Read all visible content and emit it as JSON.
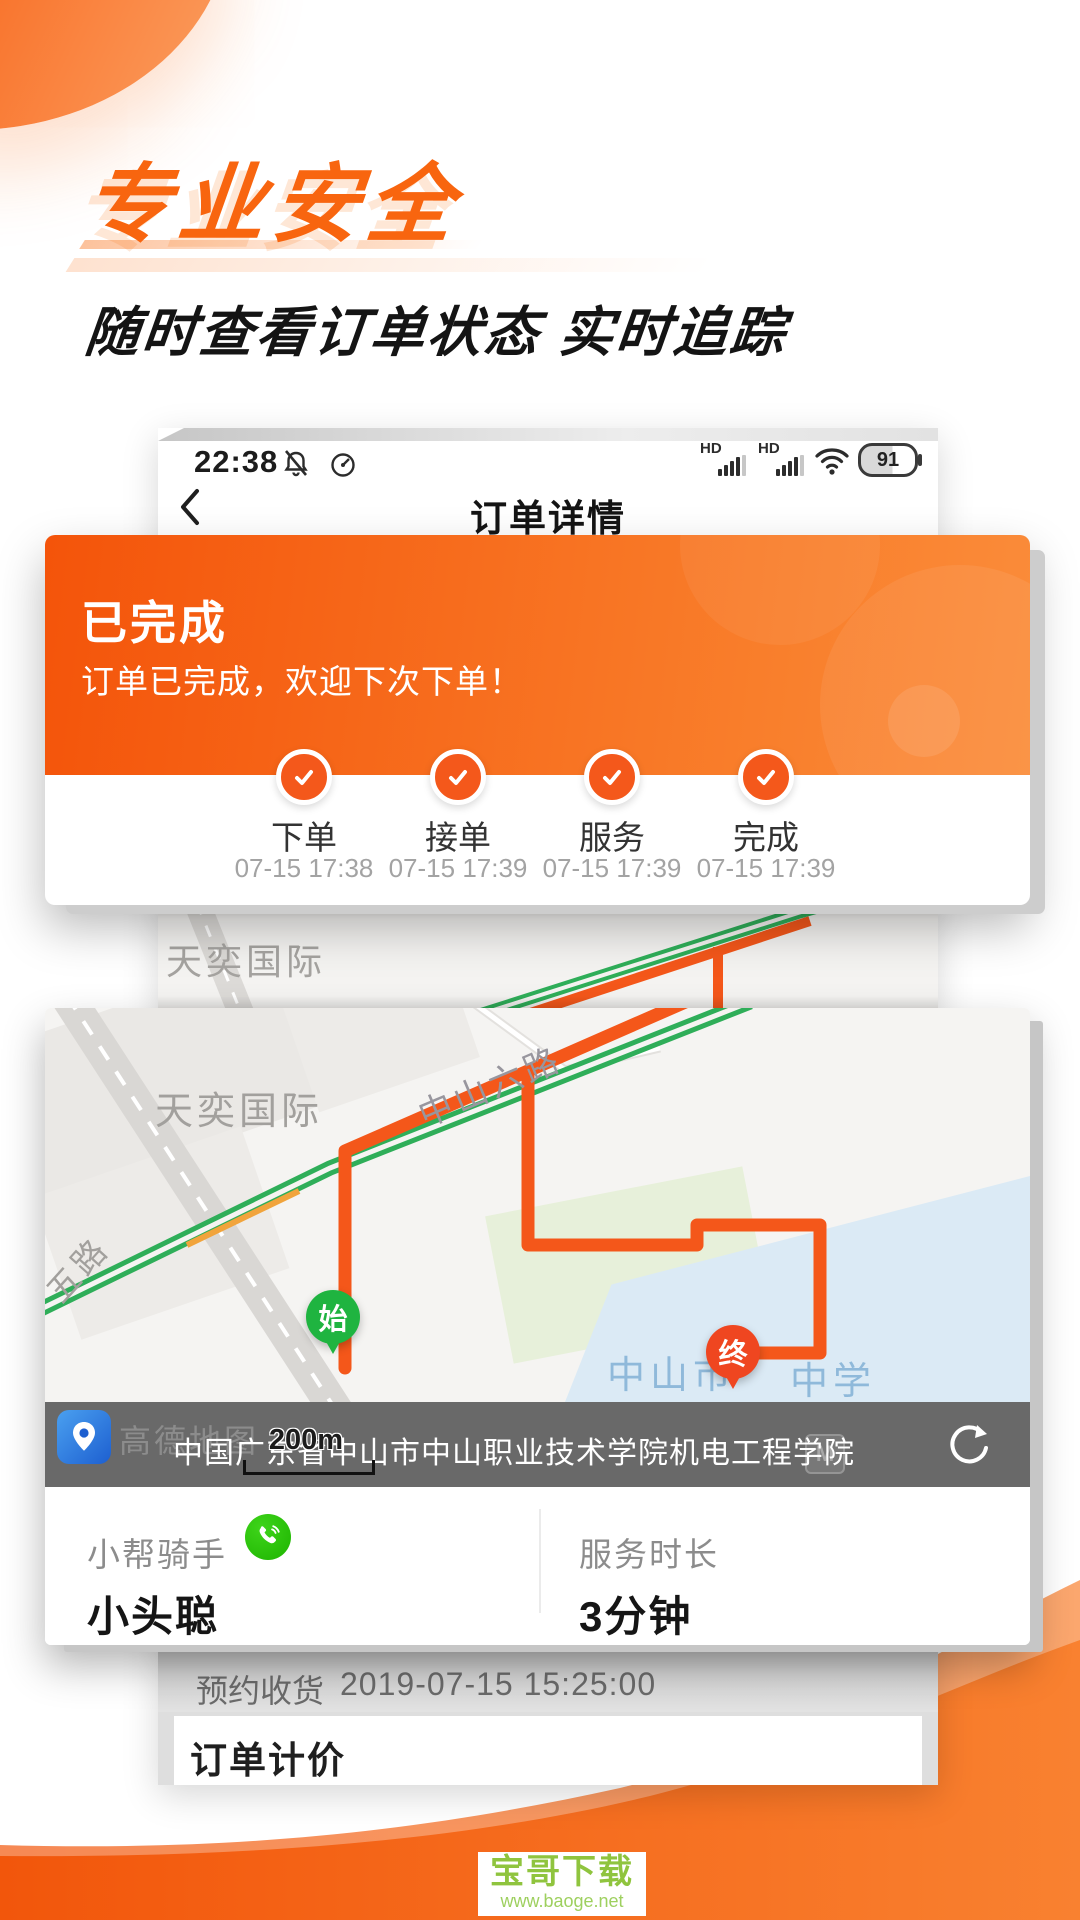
{
  "hero": {
    "title": "专业安全",
    "subtitle": "随时查看订单状态  实时追踪"
  },
  "statusbar": {
    "time": "22:38",
    "hd": "HD",
    "battery": "91"
  },
  "navbar": {
    "title": "订单详情"
  },
  "status_card": {
    "state": "已完成",
    "message": "订单已完成，欢迎下次下单！",
    "steps": [
      {
        "label": "下单",
        "time": "07-15 17:38"
      },
      {
        "label": "接单",
        "time": "07-15 17:39"
      },
      {
        "label": "服务",
        "time": "07-15 17:39"
      },
      {
        "label": "完成",
        "time": "07-15 17:39"
      }
    ]
  },
  "map": {
    "district_bg": "天奕国际",
    "district": "天奕国际",
    "road_main": "中山六路",
    "road_left": "五路",
    "school_left": "中山市",
    "school_right": "中学",
    "start_pin": "始",
    "end_pin": "终",
    "scale": "200m",
    "metro": "M",
    "amap_name": "高德地图",
    "address": "中国广东省中山市中山职业技术学院机电工程学院"
  },
  "info": {
    "rider_label": "小帮骑手",
    "rider_name": "小头聪",
    "duration_label": "服务时长",
    "duration_value": "3分钟"
  },
  "order_rows": {
    "reserve_label": "预约收货",
    "reserve_value": "2019-07-15 15:25:00",
    "pricing_title": "订单计价"
  },
  "watermark": {
    "name": "宝哥下载",
    "url": "www.baoge.net"
  },
  "colors": {
    "accent": "#F4611C",
    "road_green": "#2FAE59",
    "start_green": "#1FB440",
    "end_red": "#EF4620",
    "school_blue": "#8FB9DA",
    "watermark_green": "#96C93D"
  }
}
